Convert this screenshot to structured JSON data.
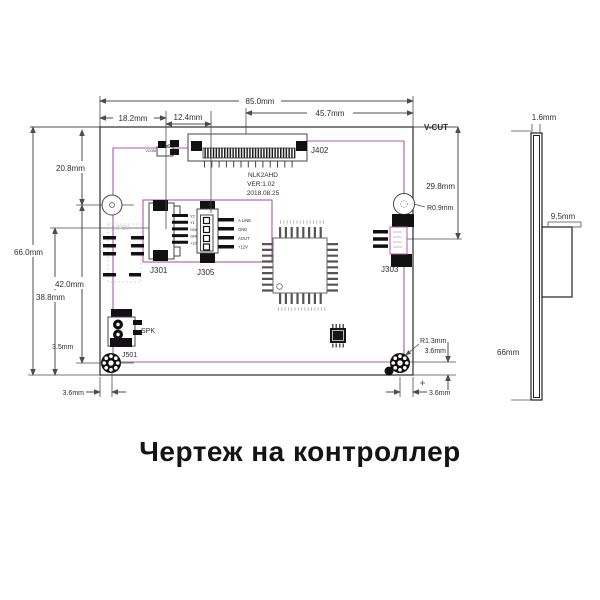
{
  "title": "Чертеж на контроллер",
  "dims": {
    "w85": "85.0mm",
    "w18": "18.2mm",
    "w12": "12.4mm",
    "w45": "45.7mm",
    "vcut": "V-CUT",
    "h66": "66.0mm",
    "h20": "20.8mm",
    "h42": "42.0mm",
    "h38": "38.8mm",
    "h35": "3.5mm",
    "bl36": "3.6mm",
    "r29": "29.8mm",
    "r09": "R0.9mm",
    "r13": "R1.3mm",
    "br36v": "3.6mm",
    "br36h": "3.6mm"
  },
  "components": {
    "j402": "J402",
    "j301": "J301",
    "j305": "J305",
    "j303": "J303",
    "j501": "J501",
    "spk": "SPK",
    "vcom": "VCOM",
    "hfd3": "HFD3"
  },
  "board_text": [
    "NLK2AHD",
    "VER:1.02",
    "2018.08.25"
  ],
  "j301_pins": [
    "Y2",
    "Y1",
    "GND",
    "GND",
    "+12V"
  ],
  "j305_pins": [
    "A LINE",
    "GND",
    "AOUT",
    "+12V"
  ],
  "side_view": {
    "t16": "1.6mm",
    "t95": "9.5mm",
    "t66": "66mm"
  },
  "colors": {
    "line": "#4d4d4d",
    "outline": "#b357b3",
    "ink": "#2e2e2e"
  }
}
